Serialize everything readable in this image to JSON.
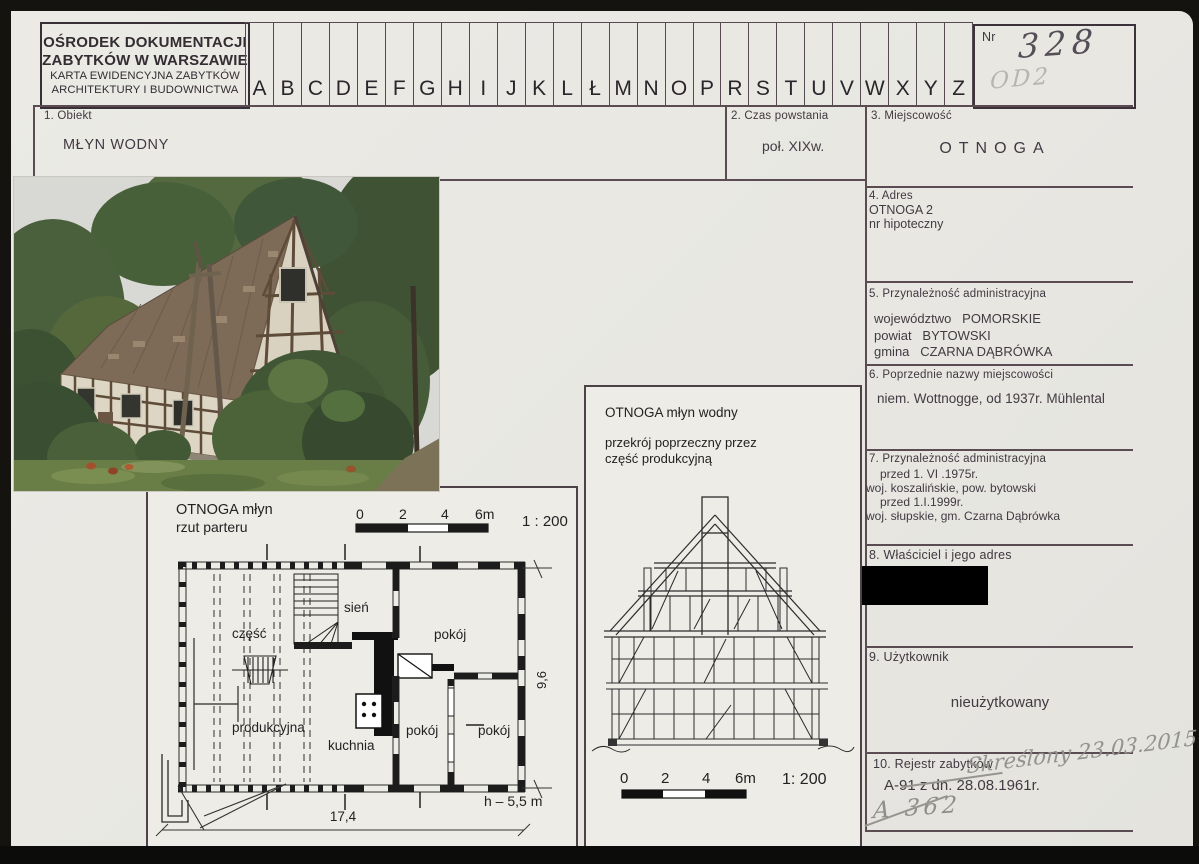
{
  "card": {
    "org": {
      "line1": "OŚRODEK DOKUMENTACJI",
      "line2": "ZABYTKÓW W WARSZAWIE",
      "line3": "KARTA EWIDENCYJNA ZABYTKÓW",
      "line4": "ARCHITEKTURY I BUDOWNICTWA"
    },
    "alphabet": [
      "A",
      "B",
      "C",
      "D",
      "E",
      "F",
      "G",
      "H",
      "I",
      "J",
      "K",
      "L",
      "Ł",
      "M",
      "N",
      "O",
      "P",
      "R",
      "S",
      "T",
      "U",
      "V",
      "W",
      "X",
      "Y",
      "Z"
    ],
    "nr": {
      "label": "Nr",
      "value": "328",
      "pencil_note": "OD2"
    }
  },
  "fields": {
    "obiekt": {
      "label": "1. Obiekt",
      "value": "MŁYN WODNY"
    },
    "czas": {
      "label": "2. Czas powstania",
      "value": "poł. XIXw."
    },
    "miejscowosc": {
      "label": "3. Miejscowość",
      "value": "OTNOGA"
    },
    "adres": {
      "label": "4. Adres",
      "line1": "OTNOGA 2",
      "line2": "nr hipoteczny"
    },
    "przynaleznosc": {
      "label": "5. Przynależność administracyjna",
      "line1": "województwo   POMORSKIE",
      "line2": "powiat   BYTOWSKI",
      "line3": "gmina   CZARNA DĄBRÓWKA"
    },
    "poprzednie_nazwy": {
      "label": "6. Poprzednie nazwy miejscowości",
      "value": "niem. Wottnogge, od 1937r. Mühlental"
    },
    "przynaleznosc_hist": {
      "label": "7. Przynależność administracyjna",
      "line1": "przed 1. VI .1975r.",
      "line2": "woj. koszalińskie, pow. bytowski",
      "line3": "przed 1.I.1999r.",
      "line4": "woj. słupskie, gm. Czarna Dąbrówka"
    },
    "wlasciciel": {
      "label": "8. Właściciel i jego adres"
    },
    "uzytkownik": {
      "label": "9. Użytkownik",
      "value": "nieużytkowany"
    },
    "rejestr": {
      "label": "10. Rejestr zabytków",
      "value": "A-91 z dn. 28.08.1961r.",
      "pencil_note1": "Skreślony 23.03.2015",
      "pencil_note2": "A 362"
    }
  },
  "plan": {
    "title_line1": "OTNOGA  młyn",
    "title_line2": "rzut parteru",
    "scale": {
      "t0": "0",
      "t2": "2",
      "t4": "4",
      "t6": "6m",
      "ratio": "1 : 200"
    },
    "rooms": {
      "sien": "sień",
      "czesc": "część",
      "produkcyjna": "produkcyjna",
      "kuchnia": "kuchnia",
      "pokoj_a": "pokój",
      "pokoj_b": "pokój",
      "pokoj_c": "pokój"
    },
    "dims": {
      "width": "17,4",
      "depth": "9,6",
      "height": "h – 5,5 m"
    }
  },
  "section": {
    "title": "OTNOGA młyn wodny",
    "subtitle_line1": "przekrój poprzeczny przez",
    "subtitle_line2": "część produkcyjną",
    "scale": {
      "t0": "0",
      "t2": "2",
      "t4": "4",
      "t6": "6m",
      "ratio": "1: 200"
    }
  },
  "colors": {
    "paper": "#e9e8e3",
    "table_line": "#5a4c52",
    "redaction": "#000000",
    "pencil": "#90908c",
    "ink": "#423a42"
  }
}
